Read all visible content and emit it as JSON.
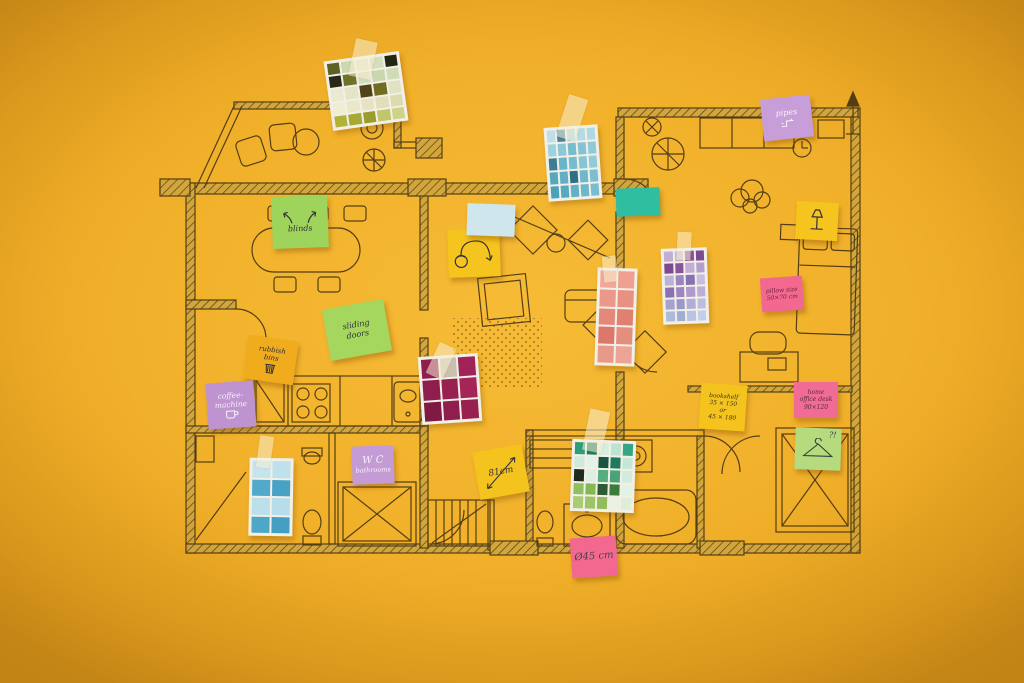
{
  "scene": {
    "description": "Top-down photo of a hand-drawn apartment floor plan on a yellow background, annotated with handwritten sticky notes and taped paint colour swatch cards",
    "background_color": "#F1B02A",
    "ink_color": "#3E2F12",
    "tape_color": "rgba(248,238,210,0.55)"
  },
  "sticky_notes": {
    "blinds": {
      "lines": [
        "blinds"
      ],
      "color": "#9fd45c",
      "icon": "curved-up-arrows"
    },
    "sliding_doors": {
      "lines": [
        "sliding",
        "doors"
      ],
      "color": "#a5d75f"
    },
    "rubbish_bins": {
      "lines": [
        "rubbish",
        "bins"
      ],
      "color": "#f0ac1c",
      "icon": "bin"
    },
    "coffee_machine": {
      "lines": [
        "coffee-",
        "machine"
      ],
      "color": "#be93cf",
      "icon": "coffee-cup"
    },
    "wc_bathrooms": {
      "lines": [
        "W C",
        "bathrooms"
      ],
      "color": "#c49bd5"
    },
    "cm81": {
      "lines": [
        "81cm"
      ],
      "color": "#f5c31d",
      "icon": "diagonal-double-arrow"
    },
    "d45": {
      "lines": [
        "Ø45 cm"
      ],
      "color": "#f2688f"
    },
    "pipes": {
      "lines": [
        "pipes"
      ],
      "color": "#c79ed8",
      "icon": "pipe-doodle"
    },
    "pillow_size": {
      "lines": [
        "pillow size",
        "50×70 cm"
      ],
      "color": "#f2688f"
    },
    "bookshelf": {
      "lines": [
        "bookshelf",
        "35 × 150",
        "or",
        "45 × 180"
      ],
      "color": "#f5c31d"
    },
    "home_office_desk": {
      "lines": [
        "home",
        "office desk",
        "90×120"
      ],
      "color": "#f06c95"
    },
    "hanger": {
      "lines": [
        "?!"
      ],
      "color": "#b5db7e",
      "icon": "clothes-hanger"
    },
    "arc_lamp": {
      "lines": [],
      "color": "#f5c41e",
      "icon": "arc-floor-lamp"
    },
    "blank_blue": {
      "lines": [],
      "color": "#cfe6ec"
    },
    "blank_teal": {
      "lines": [],
      "color": "#2fbfa0"
    },
    "table_lamp": {
      "lines": [],
      "color": "#f5c41e",
      "icon": "table-lamp"
    }
  },
  "swatch_cards": {
    "olive": {
      "name": "olive-green paint samples",
      "cols": 5,
      "colors": [
        [
          "#5c6226",
          "#ccd8ad",
          "#dce4c5",
          "#d3debc",
          "#23270f"
        ],
        [
          "#2a2818",
          "#6f7328",
          "#d2ddbd",
          "#c9d6ae",
          "#cfdcb6"
        ],
        [
          "#e9ead0",
          "#e2e6c6",
          "#514418",
          "#706c22",
          "#dee3c2"
        ],
        [
          "#efeed3",
          "#eae8ca",
          "#e5e3c1",
          "#e0dfba",
          "#dbdbb1"
        ],
        [
          "#b1b339",
          "#a6a933",
          "#9a9d2c",
          "#c0c669",
          "#cdd389"
        ]
      ]
    },
    "blue": {
      "name": "blue paint samples",
      "cols": 5,
      "colors": [
        [
          "#bcdfe9",
          "#44859d",
          "#a7d5e1",
          "#b3dbe6",
          "#aed9e3"
        ],
        [
          "#9ed2de",
          "#8ac7d7",
          "#76bccf",
          "#83c3d3",
          "#8fcad9"
        ],
        [
          "#3d7d94",
          "#6ab4c9",
          "#78bdcf",
          "#85c5d4",
          "#92ccdb"
        ],
        [
          "#56a8bf",
          "#62afc5",
          "#2e6e86",
          "#6fb7ca",
          "#7cbecf"
        ],
        [
          "#49a1ba",
          "#55a9c1",
          "#61b0c6",
          "#6db7cb",
          "#79bed0"
        ]
      ]
    },
    "purple": {
      "name": "purple paint samples",
      "cols": 4,
      "colors": [
        [
          "#c2add5",
          "#cab8db",
          "#89559a",
          "#7d4990"
        ],
        [
          "#7d4990",
          "#89559a",
          "#c2add5",
          "#b49ecf"
        ],
        [
          "#beb1d9",
          "#9c86c1",
          "#8971b4",
          "#c6bddf"
        ],
        [
          "#8971b4",
          "#9c86c1",
          "#ae9bcb",
          "#bbaed7"
        ],
        [
          "#a4a2cf",
          "#9a98c9",
          "#b0aed7",
          "#bdbcdf"
        ],
        [
          "#acbadd",
          "#9eaed5",
          "#b8c3e3",
          "#c4cde9"
        ]
      ]
    },
    "salmon": {
      "name": "salmon paint samples",
      "cols": 2,
      "colors": [
        [
          "#f2a896",
          "#efa090"
        ],
        [
          "#ec9889",
          "#e89082"
        ],
        [
          "#e4887a",
          "#e08073"
        ],
        [
          "#dc786b",
          "#e48e7e"
        ],
        [
          "#e89a8a",
          "#eca494"
        ]
      ]
    },
    "maroon": {
      "name": "maroon paint samples",
      "cols": 3,
      "colors": [
        [
          "#8f1d4e",
          "#c9c0b0",
          "#a02458"
        ],
        [
          "#8f1d4e",
          "#97214f",
          "#a62559"
        ],
        [
          "#7e1a44",
          "#8f1d4e",
          "#97224f"
        ]
      ]
    },
    "green": {
      "name": "green paint samples",
      "cols": 5,
      "colors": [
        [
          "#2d9c77",
          "#1f7d5e",
          "#d7ede0",
          "#bde4d2",
          "#35a583"
        ],
        [
          "#cfeadc",
          "#e2f2e8",
          "#16563f",
          "#1e7a5c",
          "#c7e7d6"
        ],
        [
          "#1c2b1e",
          "#ddefe3",
          "#54ae82",
          "#48a378",
          "#d2ebdd"
        ],
        [
          "#8fbf5e",
          "#84b854",
          "#2e5b33",
          "#3e7a3c",
          "#e4f2e6"
        ],
        [
          "#a9cc74",
          "#9ec468",
          "#93bc5c",
          "#e8f3e4",
          "#ddeed8"
        ]
      ]
    },
    "blue_small": {
      "name": "small blue paint samples",
      "cols": 2,
      "colors": [
        [
          "#c4e4ee",
          "#bee1ec"
        ],
        [
          "#52a9c9",
          "#47a2c4"
        ],
        [
          "#bce0eb",
          "#b6dde9"
        ],
        [
          "#4fa7c8",
          "#44a0c2"
        ]
      ]
    }
  }
}
